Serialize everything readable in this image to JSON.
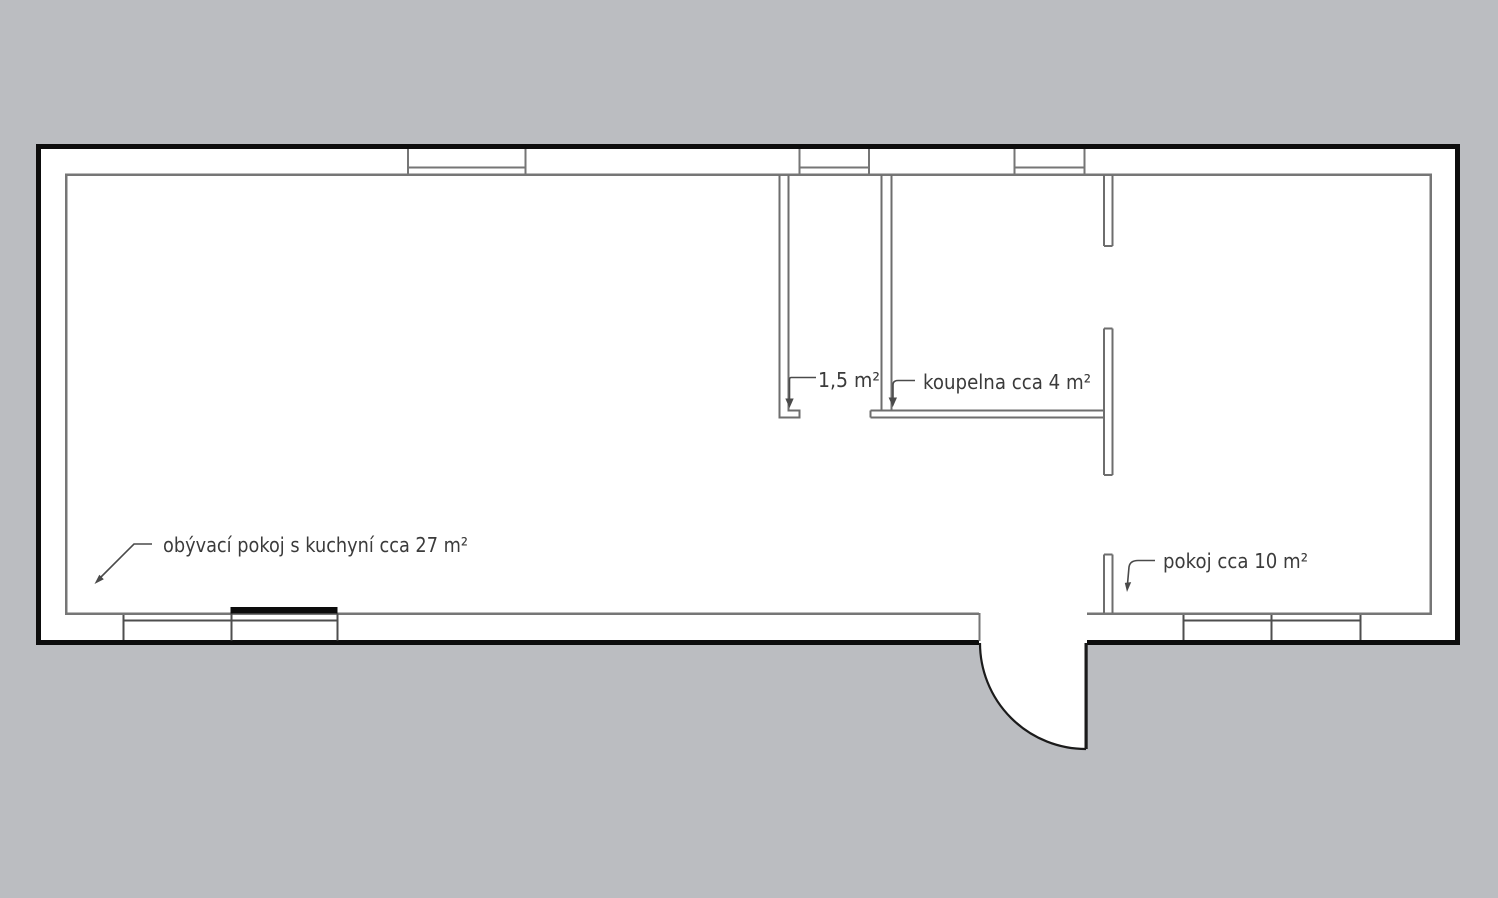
{
  "canvas": {
    "width": 1498,
    "height": 898,
    "background": "#bbbdc1"
  },
  "palette": {
    "outer_wall": "#0d0d0d",
    "inner_line": "#767676",
    "window_line": "#4e4e4e",
    "partition_line": "#6e6e6e",
    "floor": "#ffffff",
    "label_text": "#3b3b3b",
    "leader": "#4a4a4a",
    "counter_bar": "#0c0c0c",
    "door": "#1b1b1b"
  },
  "rooms": [
    {
      "id": "living-room-kitchen",
      "label": "obývací pokoj s kuchyní cca 27 m²"
    },
    {
      "id": "wc",
      "label": "1,5 m²"
    },
    {
      "id": "bathroom",
      "label": "koupelna cca 4 m²"
    },
    {
      "id": "room",
      "label": "pokoj cca 10 m²"
    }
  ]
}
